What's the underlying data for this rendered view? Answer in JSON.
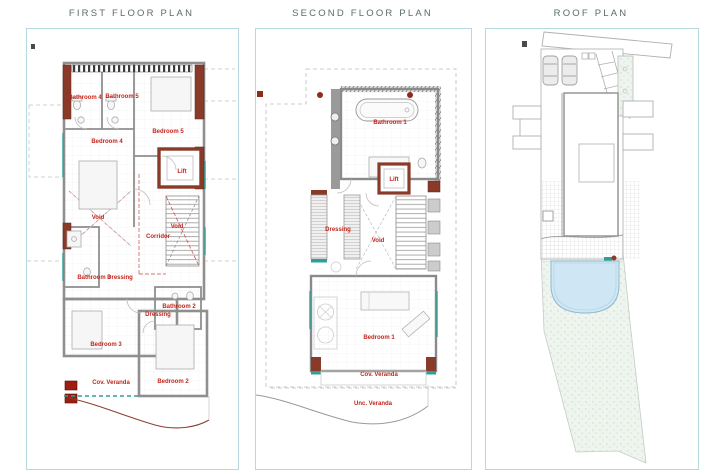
{
  "document": {
    "panels": [
      {
        "title": "FIRST FLOOR PLAN",
        "labels": [
          "Bathroom 4",
          "Bathroom 5",
          "Bedroom 5",
          "Bedroom 4",
          "Lift",
          "Void",
          "Corridor",
          "Void",
          "Bathroom 3",
          "Dressing",
          "Bathroom 2",
          "Dressing",
          "Bedroom 3",
          "Cov. Veranda",
          "Bedroom 2"
        ]
      },
      {
        "title": "SECOND FLOOR PLAN",
        "labels": [
          "Bathroom 1",
          "Lift",
          "Dressing",
          "Void",
          "Bedroom 1",
          "Cov. Veranda",
          "Unc. Veranda"
        ]
      },
      {
        "title": "ROOF PLAN",
        "labels": []
      }
    ],
    "colors": {
      "panel_border": "#b5d9de",
      "title_text": "#5d6b6b",
      "room_label_red": "#c3261d",
      "wall_gray": "#8f8f8f",
      "brick_accent": "#8a3a28",
      "red_marker": "#a01d12",
      "teal_accent": "#2fa096",
      "pool_fill": "#cfe7f5",
      "garden_fill": "#eef4ee",
      "dashed_line": "#c0c0c0"
    }
  }
}
